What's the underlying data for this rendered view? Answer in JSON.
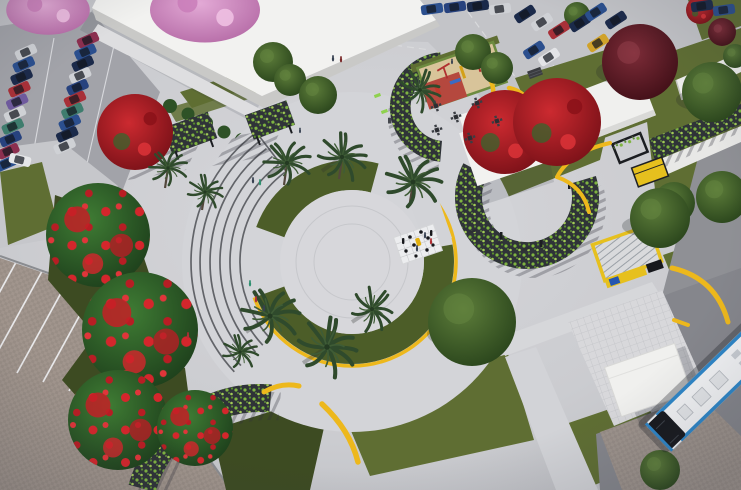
{
  "meta": {
    "title": "Aerial 3D architectural rendering of a public plaza park design",
    "description": "Bird's-eye render of an urban park: circular central plaza with olive green ring and yellow curved benches, semicircular amphitheater steps, palm trees, giant chess court, children's playground with curved vine pergola, C-shaped vine pergola promenade, red flamboyant trees, white warehouse building with car parking, food kiosks, and a bus stop with a blue-trimmed bus."
  },
  "colors": {
    "pavement": "#cdced2",
    "pavement_light": "#d8d8dc",
    "road_light": "#c3c4c8",
    "asphalt": "#a2a3a9",
    "road_dark": "#85868c",
    "paver_road": "#998c82",
    "paver_parking": "#a59a92",
    "lawn": "#5f6e33",
    "lawn_dark": "#3d4b22",
    "ring_green": "#4c5d28",
    "bench_yellow": "#edb81c",
    "building_white": "#f2f2f0",
    "building_wall": "#c9c9c7",
    "pergola_dark": "#2f3338",
    "vine_green": "#7fb441",
    "flamboyant_red": "#c32026",
    "maroon_tree": "#6e2531",
    "pink_tree": "#d795c8",
    "palm_green": "#2f4a2c",
    "tree_green": "#47682f",
    "sand": "#d8c49a",
    "rubber_red": "#b5483e",
    "bus_white": "#f2f3f5",
    "bus_blue": "#2e86c8",
    "bus_glass": "#17191e",
    "kiosk_yellow": "#e6c01e",
    "step_line": "#56585d",
    "white_line": "#e8e9ec",
    "shadow": "rgba(40,44,52,0.25)"
  },
  "car_palette": [
    "#cfd1d5",
    "#2b4f8e",
    "#1b2a4a",
    "#a83038",
    "#6f5a9e",
    "#3f7d6e",
    "#27427e",
    "#8c2f4f",
    "#d0a22a",
    "#e3e4e7"
  ],
  "scene": {
    "view": "aerial perspective, daytime, neutral gray paving dominant",
    "regions": [
      {
        "name": "parking-lot-top-left",
        "description": "Two angled rows of about 20 parked cars on asphalt beside the large building; pink blossom trees at the corner"
      },
      {
        "name": "white-building",
        "description": "Large white flat-roof warehouse building occupying the upper-left, shrub row along its front sidewalk"
      },
      {
        "name": "central-plaza",
        "description": "Circular plaza with olive-green planted ring edged in yellow seating, concentric paving bands and surrounding palm trees"
      },
      {
        "name": "amphitheater-steps",
        "description": "Six concentric curved steps opening toward the circle on its west side, a few people seated"
      },
      {
        "name": "giant-chess-court",
        "description": "Small white checkered mat with black chess pieces and one yellow piece at the plaza center-east"
      },
      {
        "name": "playground",
        "description": "Kids playground with red rubber and tan sand surfacing, colorful equipment, wrapped by a C-shaped vine pergola and yellow benches"
      },
      {
        "name": "c-shaped-pergola",
        "description": "Large C-shaped black slat pergola covered in green vines east of the plaza, casting striped shadows"
      },
      {
        "name": "flamboyant-trees",
        "description": "Row of large green trees with red flamboyant blooms along the west side and two crimson trees by the white kiosks"
      },
      {
        "name": "kiosks",
        "description": "Two white flat-roof kiosk buildings and two yellow food kiosks with black frames on the east side"
      },
      {
        "name": "bus-stop",
        "description": "White canopy shelter on a tiled platform beside the road with a white bus with blue trim at bottom right"
      },
      {
        "name": "lawns-bottom-right",
        "description": "Large olive lawn parallelograms crossed by diagonal walkways"
      },
      {
        "name": "paver-parking-bottom-left",
        "description": "Paver-surfaced parking bays with white diagonal striping at the bottom-left corner"
      },
      {
        "name": "picnic-tables",
        "description": "Cluster of small four-seat chess/picnic tables on the paving north of the kiosks"
      },
      {
        "name": "top-right-streets",
        "description": "Streets with rows of parked cars, crosswalks, maroon shade tree and far-right lawns with a straight vine pergola"
      }
    ]
  },
  "objects": {
    "parked_cars_left_lot": 20,
    "cars_top_right_streets": 12,
    "palm_trees": 10,
    "flamboyant_trees": 7,
    "pergolas": 6,
    "yellow_benches": 8,
    "kiosks": 4,
    "buses": 1,
    "picnic_tables": 6,
    "amphitheater_steps": 6
  }
}
